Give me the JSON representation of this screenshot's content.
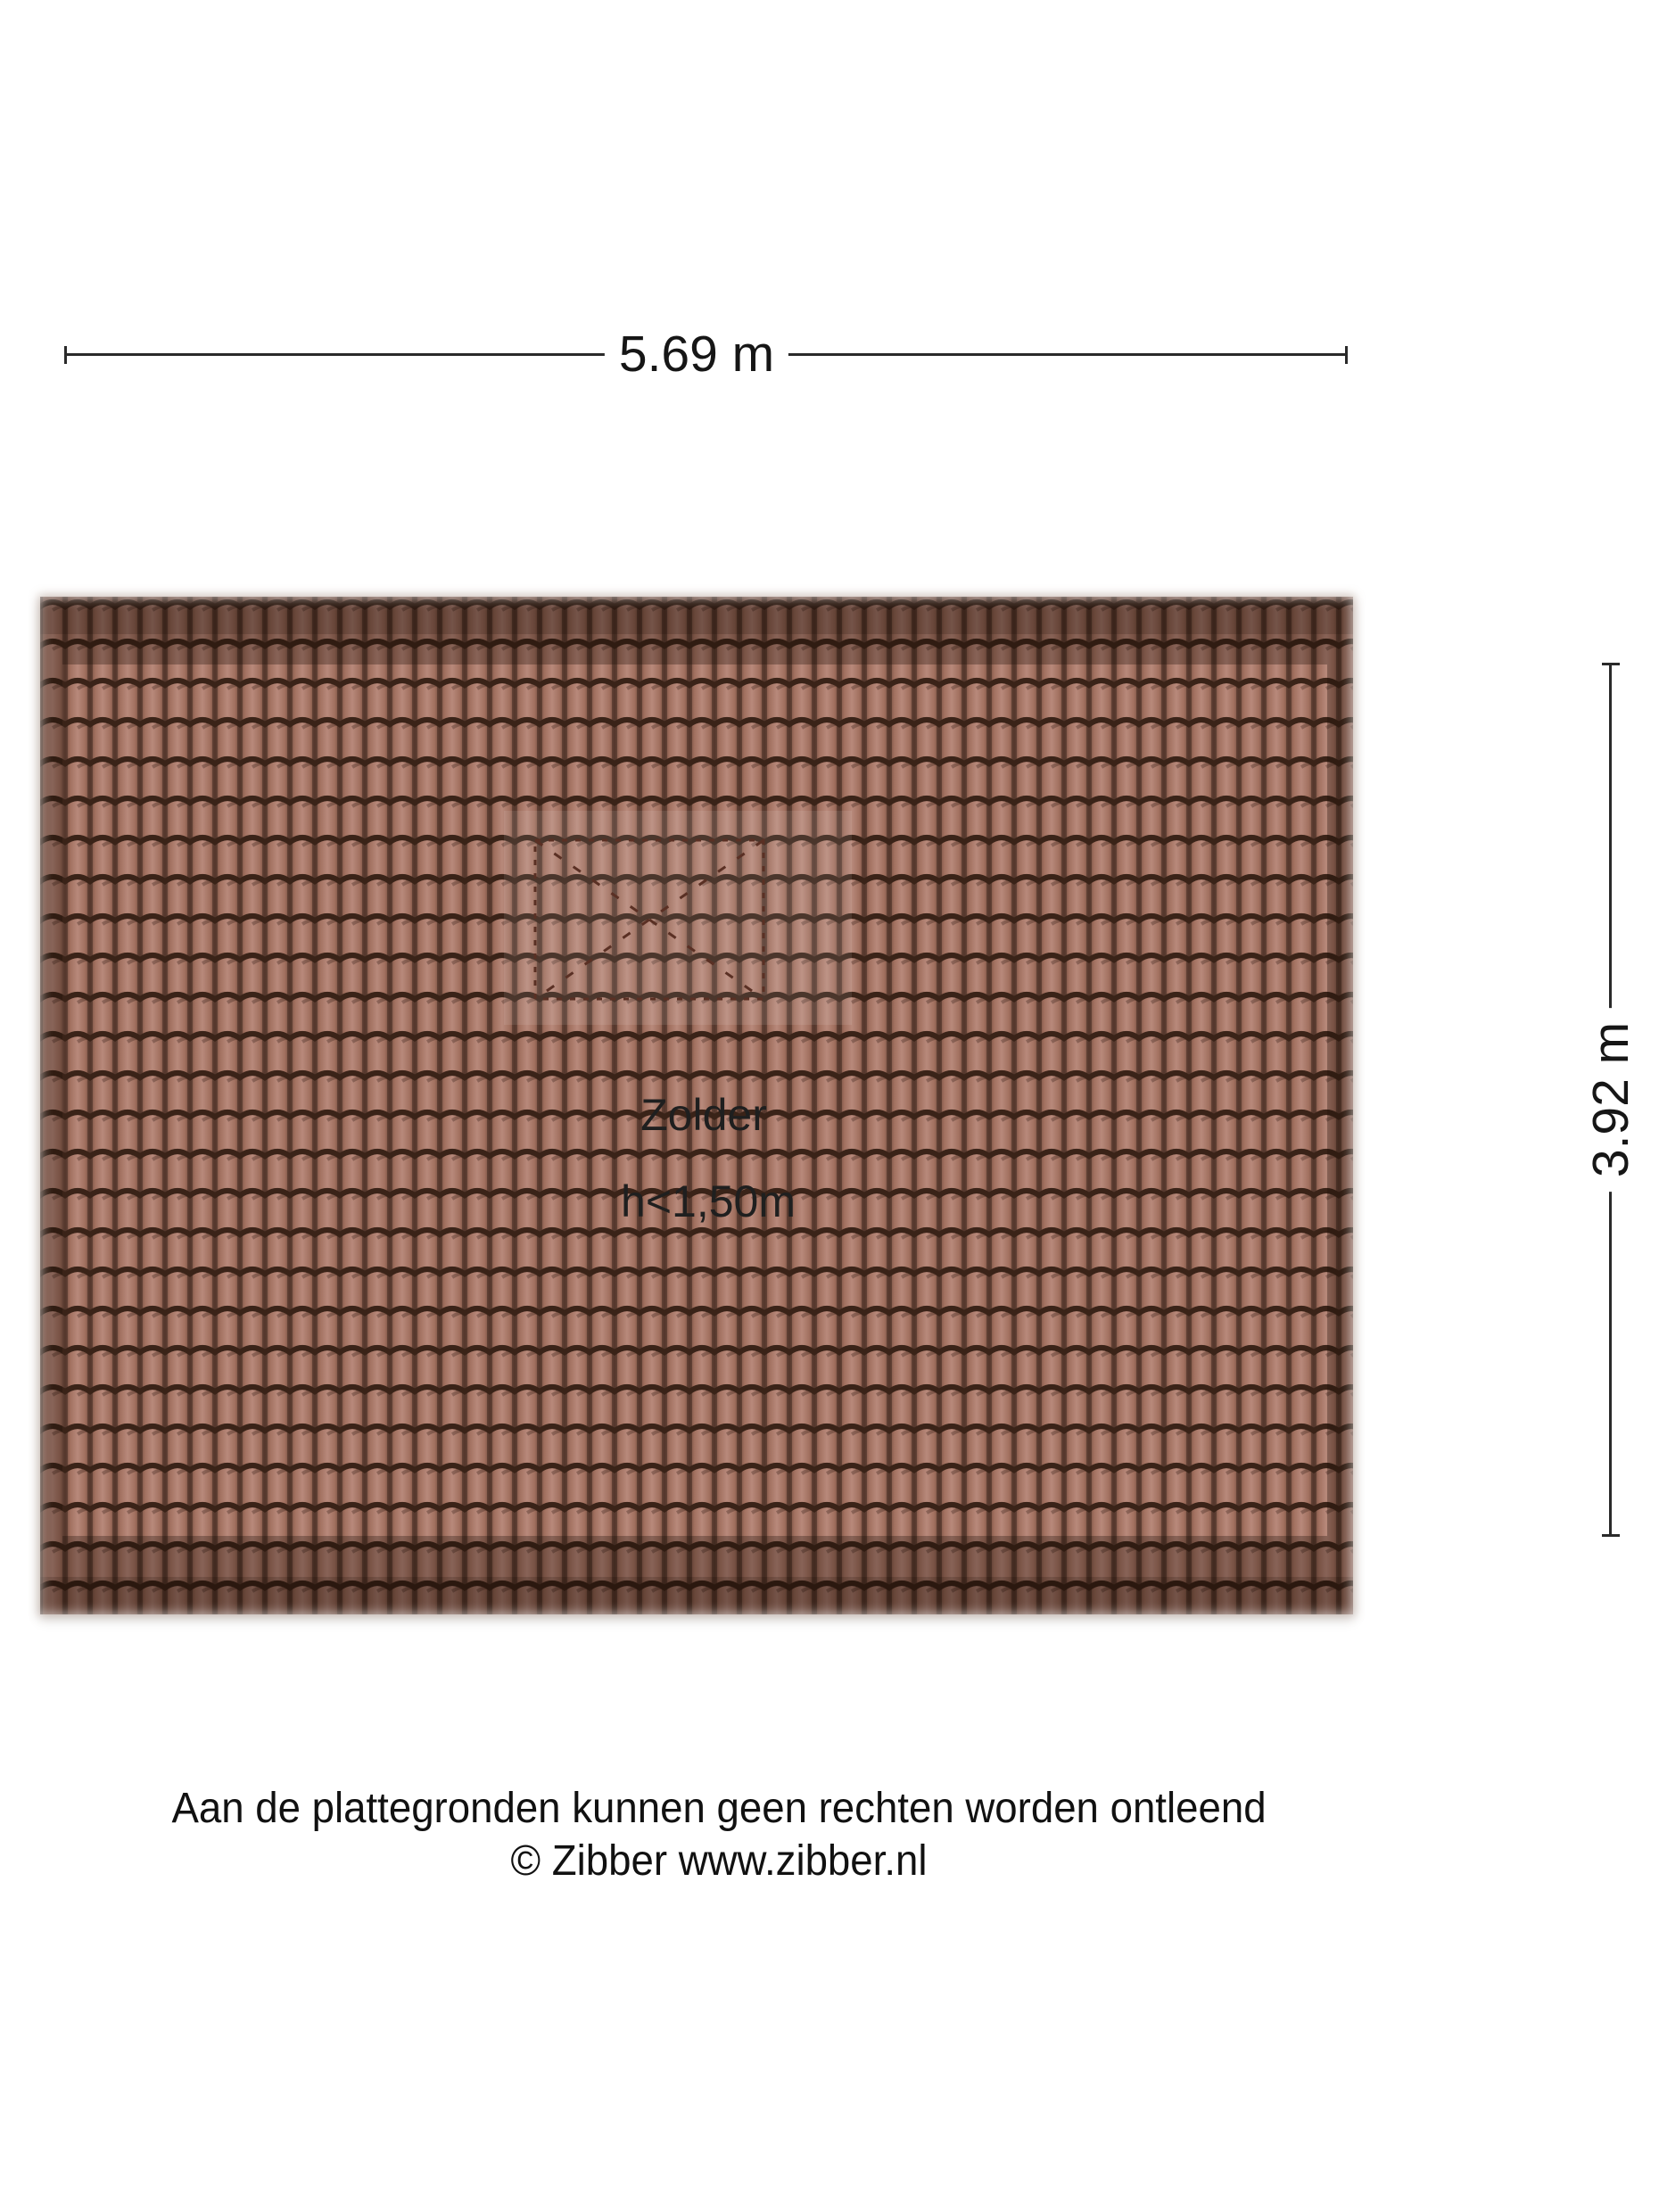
{
  "plan": {
    "room": {
      "name": "Zolder",
      "height_note": "h<1,50m"
    },
    "dimensions": {
      "width_label": "5.69 m",
      "depth_label": "3.92 m"
    },
    "features": {
      "skylight": "dashed-skylight-outline"
    }
  },
  "footer": {
    "disclaimer": "Aan de plattegronden kunnen geen rechten worden ontleend",
    "copyright": "© Zibber www.zibber.nl"
  },
  "colors": {
    "page_bg": "#ffffff",
    "dim_line": "#2a2a2a",
    "text": "#1c1c1c",
    "tile_edge": "#6e4a3d",
    "tile_mid": "#a1705f",
    "tile_light": "#b8897b",
    "tile_groove": "#3a2318",
    "tile_groove_shadow": "rgba(30,12,5,0.28)",
    "tile_seam": "rgba(52,30,22,0.45)",
    "eaves_overlay": "rgba(28,13,6,0.30)",
    "ridge_overlay": "rgba(18,7,2,0.16)",
    "skylight_stroke": "#5a3024",
    "skylight_patch": "rgba(255,255,255,0.09)"
  }
}
